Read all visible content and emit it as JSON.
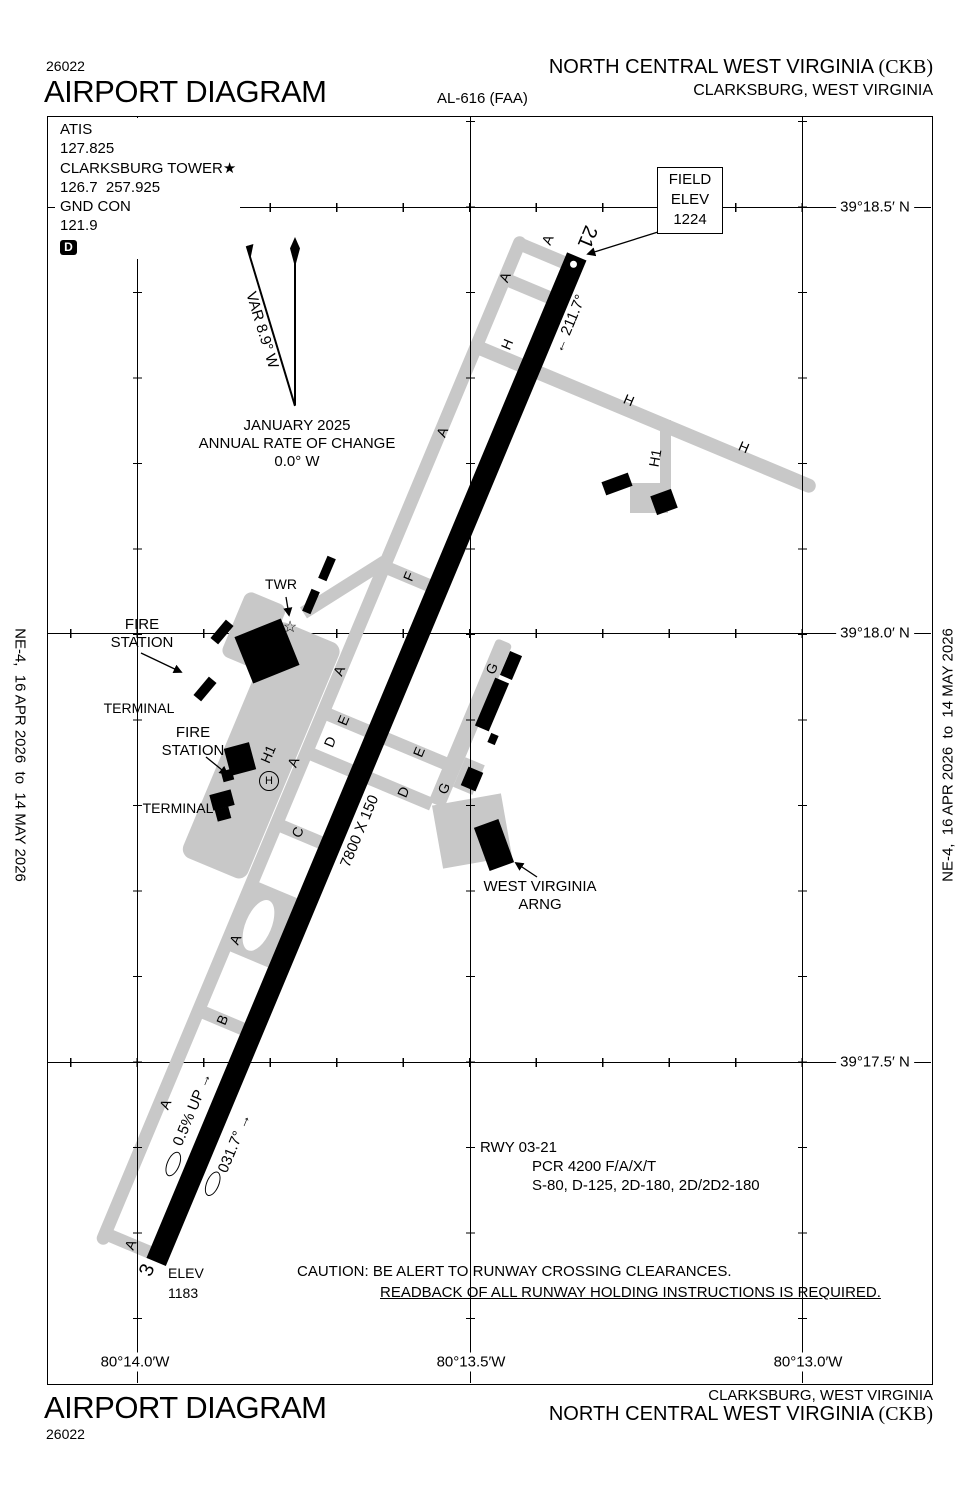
{
  "colors": {
    "taxiway_gray": "#c8c8c8",
    "ink": "#000000",
    "paper": "#ffffff"
  },
  "header": {
    "plate_number": "26022",
    "title": "AIRPORT DIAGRAM",
    "procedure_id": "AL-616 (FAA)",
    "airport_name": "NORTH CENTRAL WEST VIRGINIA ",
    "airport_icao": "(CKB)",
    "city": "CLARKSBURG, WEST VIRGINIA"
  },
  "margin": {
    "effective_dates": "NE-4,  16 APR 2026  to  14 MAY 2026"
  },
  "comm": {
    "atis_label": "ATIS",
    "atis_freq": "127.825",
    "twr_label": "CLARKSBURG TOWER",
    "twr_note": "★",
    "twr_freqs": "126.7  257.925",
    "gnd_label": "GND CON",
    "gnd_freq": "121.9",
    "datis": "D"
  },
  "compass": {
    "variation": "VAR 8.9° W",
    "date": "JANUARY 2025",
    "rate_line1": "ANNUAL RATE OF CHANGE",
    "rate_line2": "0.0° W"
  },
  "field_elev": {
    "line1": "FIELD",
    "line2": "ELEV",
    "line3": "1224"
  },
  "grid": {
    "lat": [
      "39°18.5′ N",
      "39°18.0′ N",
      "39°17.5′ N"
    ],
    "lon": [
      "80°14.0′W",
      "80°13.5′W",
      "80°13.0′W"
    ]
  },
  "runway": {
    "end21_label": "21",
    "end3_label": "3",
    "hdg_21": "← 211.7°",
    "hdg_03": "031.7° →",
    "dimensions": "7800 X 150",
    "gradient": "0.5% UP →",
    "elev_3_line1": "ELEV",
    "elev_3_line2": "1183"
  },
  "rwy_data": {
    "title": "RWY 03-21",
    "pcr": "PCR 4200 F/A/X/T",
    "strength": "S-80, D-125, 2D-180, 2D/2D2-180"
  },
  "caution": {
    "line1": "CAUTION: BE ALERT TO RUNWAY CROSSING CLEARANCES.",
    "line2": "READBACK OF ALL RUNWAY HOLDING INSTRUCTIONS IS REQUIRED."
  },
  "taxiways": {
    "a": "A",
    "b": "B",
    "c": "C",
    "d": "D",
    "e": "E",
    "f": "F",
    "g": "G",
    "h": "H",
    "h1": "H1"
  },
  "facilities": {
    "twr": "TWR",
    "fire_l1": "FIRE",
    "fire_l2": "STATION",
    "terminal": "TERMINAL",
    "helipad_h": "H",
    "arng_l1": "WEST VIRGINIA",
    "arng_l2": "ARNG"
  }
}
